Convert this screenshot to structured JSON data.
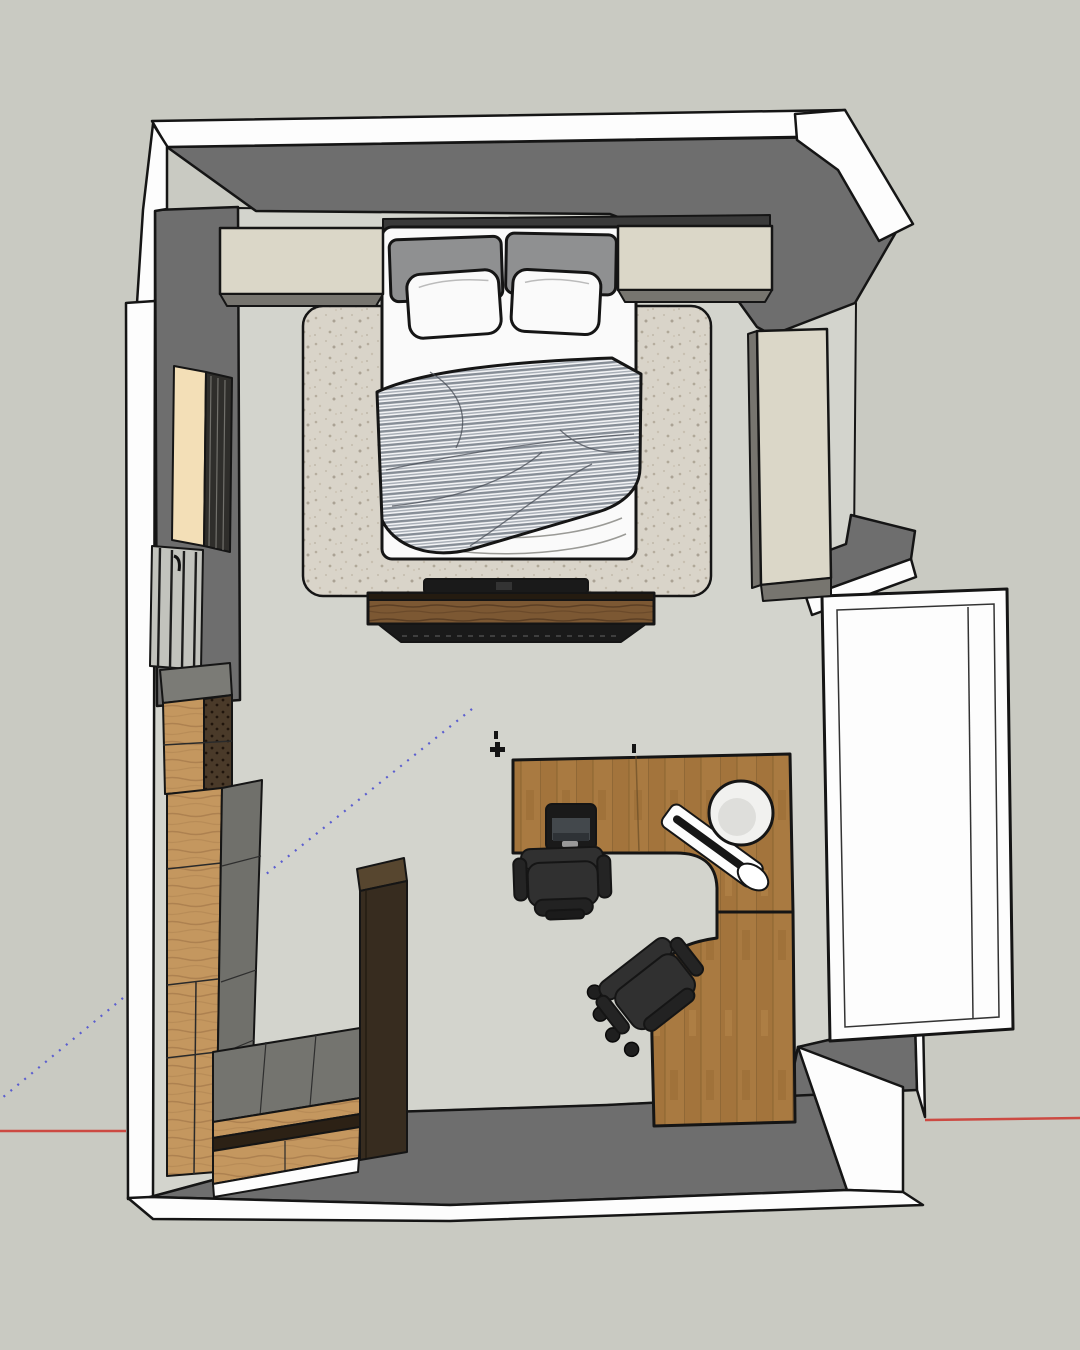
{
  "view": {
    "type": "3d-model-viewport-top-view",
    "scene": "bedroom with home office floor plan",
    "camera": "overhead plan view with slight perspective"
  },
  "palette": {
    "background": "#c9cac2",
    "floor": "#d3d4cd",
    "wall_cut": "#fdfdfd",
    "wall_face": "#6e6e6e",
    "outline": "#151515",
    "cabinet_cream": "#dbd7c8",
    "cabinet_shadow": "#77756f",
    "bed_white": "#fafafa",
    "pillow_gray": "#8f9091",
    "duvet_light": "#f2f3f5",
    "duvet_stripe": "#868d96",
    "rug_base": "#d9d4c9",
    "rug_speckle": "#b4ab9c",
    "wood_desk": "#a97a41",
    "wood_light": "#c4975f",
    "wood_bench": "#7c5833",
    "wood_dark_cabinet": "#372c1f",
    "radiator_cream": "#f3dfb7",
    "window_glass": "#c2c3bd",
    "furniture_black": "#1a1a1a",
    "chair_gray": "#303030",
    "lamp_white": "#f1f1ef",
    "axis_red": "#cc4a42",
    "guide_blue": "#5b5ecf"
  },
  "markers": {
    "axis_line": "red-x-axis-line",
    "guide_line": "dotted-construction-guide-line",
    "guide_point": "cross-guide-point-marker"
  },
  "objects": [
    {
      "id": "walls",
      "label": "room walls (white cut tops, gray faces)"
    },
    {
      "id": "floor",
      "label": "room floor"
    },
    {
      "id": "area-rug",
      "label": "speckled area rug under bed"
    },
    {
      "id": "double-bed",
      "label": "double bed with white sheets"
    },
    {
      "id": "duvet",
      "label": "striped gray duvet"
    },
    {
      "id": "pillows",
      "label": "two gray back pillows, two white pillows"
    },
    {
      "id": "headboard",
      "label": "dark headboard strip"
    },
    {
      "id": "headboard-cabinet-left",
      "label": "cream overhead cabinet left of bed"
    },
    {
      "id": "headboard-cabinet-right",
      "label": "cream overhead cabinet right of bed"
    },
    {
      "id": "wardrobe-right-wall",
      "label": "cream wardrobe on right wall"
    },
    {
      "id": "shelf-return",
      "label": "gray wall return / shelf right side"
    },
    {
      "id": "door-panel",
      "label": "white door leaf open outside right wall"
    },
    {
      "id": "media-bench",
      "label": "wooden media bench at bed foot"
    },
    {
      "id": "tv",
      "label": "flat TV on media bench"
    },
    {
      "id": "radiator",
      "label": "radiator on left wall"
    },
    {
      "id": "window",
      "label": "window / glazed door on left wall"
    },
    {
      "id": "wardrobe-left",
      "label": "tall wood wardrobe along left wall"
    },
    {
      "id": "drawer-bench",
      "label": "low drawer bench bottom-left corner"
    },
    {
      "id": "tall-dark-cabinet",
      "label": "tall dark brown cabinet"
    },
    {
      "id": "corner-desk",
      "label": "L-shaped wooden desk with curved cutouts"
    },
    {
      "id": "monitor",
      "label": "monitor on desk"
    },
    {
      "id": "desk-lamp",
      "label": "white desk lamp with round shade"
    },
    {
      "id": "office-chair-1",
      "label": "office chair at upper desk"
    },
    {
      "id": "office-chair-2",
      "label": "office chair at lower desk"
    }
  ]
}
